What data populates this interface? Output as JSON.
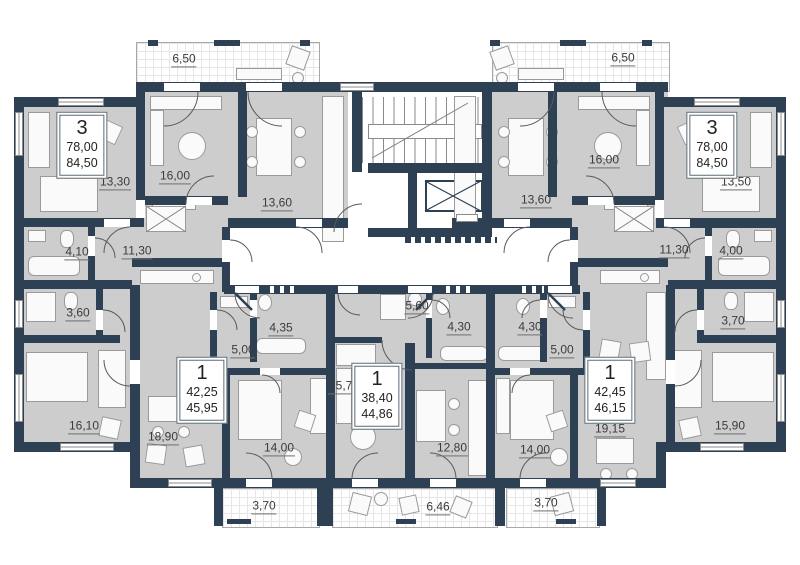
{
  "plan_colors": {
    "wall": "#2e4154",
    "room_fill": "#cdcdcd",
    "balcony_line": "#a8a8a8",
    "label_text": "#3b3b3b"
  },
  "room_labels": [
    {
      "text": "6,50",
      "x": 184,
      "y": 60
    },
    {
      "text": "13,30",
      "x": 115,
      "y": 183
    },
    {
      "text": "16,00",
      "x": 175,
      "y": 177
    },
    {
      "text": "13,60",
      "x": 277,
      "y": 204
    },
    {
      "text": "4,10",
      "x": 77,
      "y": 253
    },
    {
      "text": "11,30",
      "x": 137,
      "y": 252
    },
    {
      "text": "3,60",
      "x": 78,
      "y": 314
    },
    {
      "text": "16,10",
      "x": 84,
      "y": 427
    },
    {
      "text": "18,90",
      "x": 163,
      "y": 438
    },
    {
      "text": "4,35",
      "x": 281,
      "y": 329
    },
    {
      "text": "5,00",
      "x": 243,
      "y": 351
    },
    {
      "text": "14,00",
      "x": 279,
      "y": 449
    },
    {
      "text": "3,70",
      "x": 264,
      "y": 507
    },
    {
      "text": "5,60",
      "x": 417,
      "y": 307
    },
    {
      "text": "15,70",
      "x": 344,
      "y": 387
    },
    {
      "text": "12,80",
      "x": 452,
      "y": 449
    },
    {
      "text": "6,46",
      "x": 438,
      "y": 508
    },
    {
      "text": "4,30",
      "x": 459,
      "y": 328
    },
    {
      "text": "4,30",
      "x": 530,
      "y": 328
    },
    {
      "text": "5,00",
      "x": 562,
      "y": 351
    },
    {
      "text": "14,00",
      "x": 535,
      "y": 451
    },
    {
      "text": "3,70",
      "x": 546,
      "y": 504
    },
    {
      "text": "19,15",
      "x": 610,
      "y": 430
    },
    {
      "text": "6,50",
      "x": 623,
      "y": 59
    },
    {
      "text": "16,00",
      "x": 604,
      "y": 161
    },
    {
      "text": "13,60",
      "x": 536,
      "y": 201
    },
    {
      "text": "13,50",
      "x": 736,
      "y": 183
    },
    {
      "text": "11,30",
      "x": 674,
      "y": 251
    },
    {
      "text": "4,00",
      "x": 731,
      "y": 252
    },
    {
      "text": "3,70",
      "x": 733,
      "y": 322
    },
    {
      "text": "15,90",
      "x": 730,
      "y": 427
    }
  ],
  "apartments": [
    {
      "rooms": "3",
      "area_living": "78,00",
      "area_total": "84,50",
      "x": 82,
      "y": 145
    },
    {
      "rooms": "1",
      "area_living": "42,25",
      "area_total": "45,95",
      "x": 202,
      "y": 390
    },
    {
      "rooms": "1",
      "area_living": "38,40",
      "area_total": "44,86",
      "x": 377,
      "y": 396
    },
    {
      "rooms": "1",
      "area_living": "42,45",
      "area_total": "46,15",
      "x": 610,
      "y": 390
    },
    {
      "rooms": "3",
      "area_living": "78,00",
      "area_total": "84,50",
      "x": 712,
      "y": 145
    }
  ]
}
